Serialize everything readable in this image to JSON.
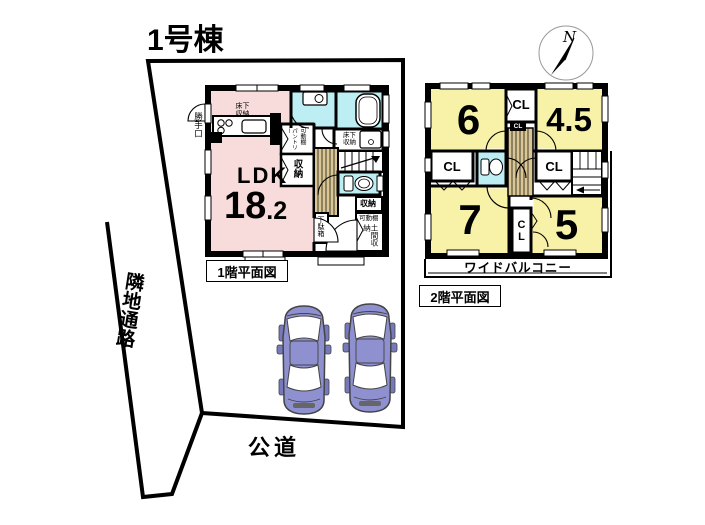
{
  "title": "1号棟",
  "compass": {
    "north": "N"
  },
  "site": {
    "passage": "隣地通路",
    "road": "公道"
  },
  "floor1": {
    "caption": "1階平面図",
    "ldk_label": "LDK",
    "ldk_area_int": "18",
    "ldk_area_frac": ".2",
    "kitchen_underfloor": "床下収納",
    "back_door": "勝手口",
    "pantry": "パントリー",
    "pantry_shelf": "可動棚",
    "hall_closet": "収納",
    "vanity_underfloor": "床下収納",
    "toilet_closet": "収納",
    "shoe_cabinet": "下駄箱",
    "entry_shelf": "可動棚",
    "entry_storage": "土間収納"
  },
  "floor2": {
    "caption": "2階平面図",
    "room_6": "6",
    "room_4_5": "4.5",
    "room_7": "7",
    "room_5": "5",
    "closet_top": "CL",
    "closet_top_small": "CL",
    "closet_left": "CL",
    "closet_right": "CL",
    "closet_mid": "CL",
    "balcony": "ワイドバルコニー"
  },
  "colors": {
    "ldk_pink": "#f8dcdc",
    "wet_cyan": "#bdeef4",
    "room_yellow": "#f7f2a8",
    "stair_tan": "#dbc795",
    "car_purple": "#8e90cf"
  }
}
